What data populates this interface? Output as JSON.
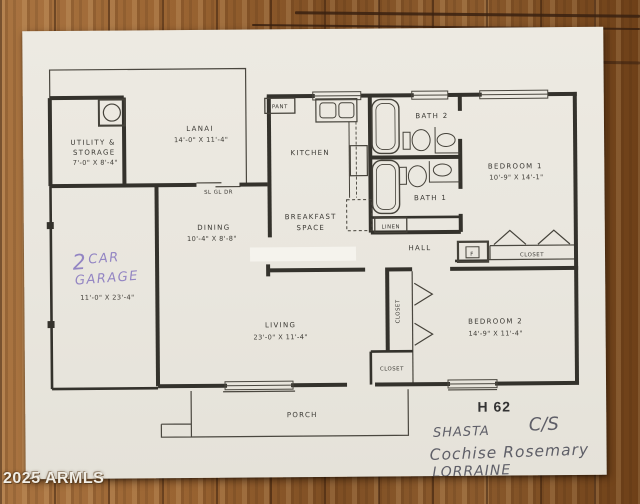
{
  "watermark": "2025 ARMLS",
  "plan": {
    "code": "H 62",
    "rooms": {
      "lanai": {
        "name": "LANAI",
        "dims": "14'-0\" X 11'-4\""
      },
      "utility": {
        "name1": "UTILITY &",
        "name2": "STORAGE",
        "dims": "7'-0\" X 8'-4\""
      },
      "kitchen": {
        "name": "KITCHEN"
      },
      "breakfast": {
        "name1": "BREAKFAST",
        "name2": "SPACE"
      },
      "dining": {
        "name": "DINING",
        "dims": "10'-4\" X 8'-8\""
      },
      "living": {
        "name": "LIVING",
        "dims": "23'-0\" X 11'-4\""
      },
      "garage": {
        "dims": "11'-0\" X 23'-4\""
      },
      "bedroom1": {
        "name": "BEDROOM 1",
        "dims": "10'-9\" X 14'-1\""
      },
      "bedroom2": {
        "name": "BEDROOM 2",
        "dims": "14'-9\" X 11'-4\""
      },
      "bath1": {
        "name": "BATH 1"
      },
      "bath2": {
        "name": "BATH 2"
      },
      "hall": {
        "name": "HALL"
      },
      "porch": {
        "name": "PORCH"
      }
    },
    "labels": {
      "pantry": "PANT",
      "linen": "LINEN",
      "sliding_door": "SL GL DR",
      "closet": "CLOSET",
      "furnace": "F"
    }
  },
  "handwriting": {
    "garage_digit": "2",
    "garage_word1": "CAR",
    "garage_word2": "GARAGE",
    "note_name": "SHASTA",
    "note_cs": "C/S",
    "note_line2": "Cochise Rosemary",
    "note_line3": "LORRAINE"
  },
  "colors": {
    "paper": "#e9e6de",
    "ink": "#38362f",
    "pen": "#8a7bc0",
    "pencil": "#5f5f68",
    "wood_light": "#a97441",
    "wood_dark": "#6e4018"
  }
}
